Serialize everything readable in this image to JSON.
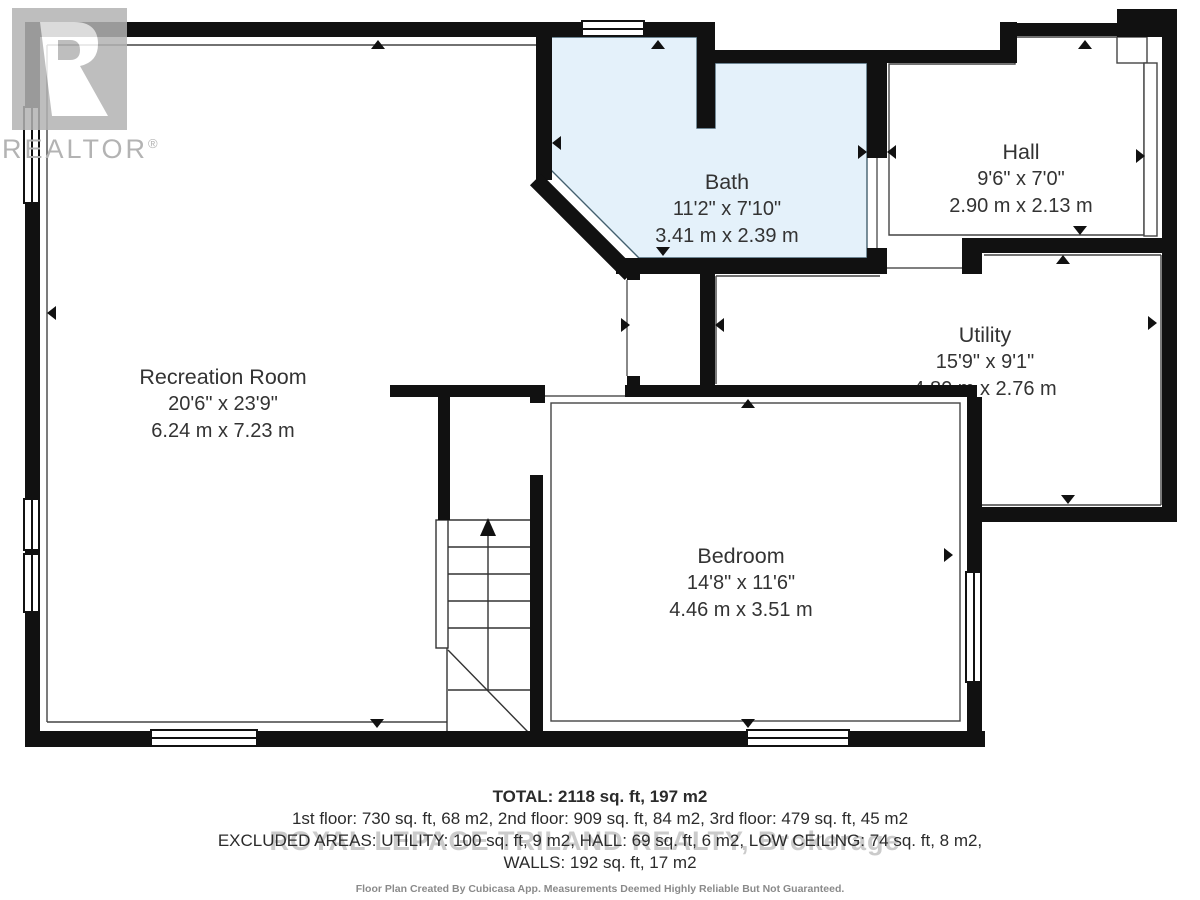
{
  "branding": {
    "logo_letter": "R",
    "realtor_label": "REALTOR",
    "registered_mark": "®",
    "watermark": "ROYAL LEPAGE TRILAND REALTY, Brokerage"
  },
  "rooms": [
    {
      "name": "Recreation Room",
      "imperial": "20'6\" x 23'9\"",
      "metric": "6.24 m x 7.23 m"
    },
    {
      "name": "Bath",
      "imperial": "11'2\" x 7'10\"",
      "metric": "3.41 m x 2.39 m"
    },
    {
      "name": "Hall",
      "imperial": "9'6\" x 7'0\"",
      "metric": "2.90 m x 2.13 m"
    },
    {
      "name": "Utility",
      "imperial": "15'9\" x 9'1\"",
      "metric": "4.80 m x 2.76 m"
    },
    {
      "name": "Bedroom",
      "imperial": "14'8\" x 11'6\"",
      "metric": "4.46 m x 3.51 m"
    }
  ],
  "summary": {
    "total": "TOTAL: 2118 sq. ft, 197 m2",
    "floors": "1st floor: 730 sq. ft, 68 m2, 2nd floor: 909 sq. ft, 84 m2, 3rd floor: 479 sq. ft, 45 m2",
    "excluded": "EXCLUDED AREAS: UTILITY: 100 sq. ft, 9 m2, HALL: 69 sq. ft, 6 m2, LOW CEILING: 74 sq. ft, 8 m2,",
    "walls": "WALLS: 192 sq. ft, 17 m2",
    "disclaimer": "Floor Plan Created By Cubicasa App. Measurements Deemed Highly Reliable But Not Guaranteed."
  },
  "colors": {
    "wall": "#111111",
    "bath_fill": "#e4f1fa",
    "outline": "#444444",
    "watermark": "#cbcbcb",
    "logo_gray": "#b3b3b3"
  }
}
